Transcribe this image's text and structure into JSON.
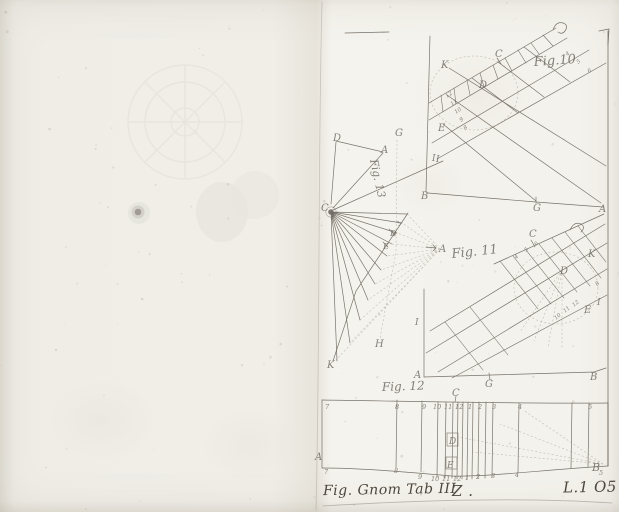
{
  "colors": {
    "paper": "#f0eee7",
    "plate_paper": "#f4f2ec",
    "ink": "#514c44",
    "faint_ink": "#8c8779"
  },
  "caption": {
    "figure_line": "Fig. Gnom Tab III",
    "center_mark": "Z .",
    "signature": "L.1 O5"
  },
  "figures": {
    "fig10": {
      "labels": [
        {
          "n": "title",
          "t": "Fig.10",
          "x": 534,
          "y": 66,
          "s": 13,
          "r": -4
        },
        {
          "n": "K",
          "t": "K",
          "x": 441,
          "y": 68,
          "s": 10
        },
        {
          "n": "C",
          "t": "C",
          "x": 495,
          "y": 57,
          "s": 10
        },
        {
          "n": "D",
          "t": "D",
          "x": 479,
          "y": 88,
          "s": 10
        },
        {
          "n": "E",
          "t": "E",
          "x": 438,
          "y": 131,
          "s": 10
        },
        {
          "n": "I",
          "t": "I",
          "x": 432,
          "y": 161,
          "s": 9
        },
        {
          "n": "B",
          "t": "B",
          "x": 421,
          "y": 199,
          "s": 10
        },
        {
          "n": "G",
          "t": "G",
          "x": 533,
          "y": 211,
          "s": 10
        },
        {
          "n": "A",
          "t": "A",
          "x": 599,
          "y": 212,
          "s": 10
        },
        {
          "n": "t4",
          "t": "4",
          "x": 567,
          "y": 56,
          "s": 5.5,
          "r": -35
        },
        {
          "n": "t5",
          "t": "5",
          "x": 578,
          "y": 64,
          "s": 5.5,
          "r": -35
        },
        {
          "n": "t6",
          "t": "6",
          "x": 589,
          "y": 73,
          "s": 5.5,
          "r": -35
        },
        {
          "n": "t12",
          "t": "12",
          "x": 447,
          "y": 98,
          "s": 5.5,
          "r": -35
        },
        {
          "n": "t11",
          "t": "11",
          "x": 452,
          "y": 106,
          "s": 5.5,
          "r": -35
        },
        {
          "n": "t10",
          "t": "10",
          "x": 456,
          "y": 114,
          "s": 5.5,
          "r": -35
        },
        {
          "n": "t9",
          "t": "9",
          "x": 461,
          "y": 122,
          "s": 5.5,
          "r": -35
        },
        {
          "n": "t8",
          "t": "8",
          "x": 465,
          "y": 130,
          "s": 5.5,
          "r": -35
        }
      ]
    },
    "fig11": {
      "labels": [
        {
          "n": "title",
          "t": "Fig. 11",
          "x": 452,
          "y": 258,
          "s": 13,
          "r": -6
        },
        {
          "n": "C",
          "t": "C",
          "x": 529,
          "y": 237,
          "s": 10
        },
        {
          "n": "K",
          "t": "K",
          "x": 588,
          "y": 257,
          "s": 10
        },
        {
          "n": "D",
          "t": "D",
          "x": 560,
          "y": 274,
          "s": 10
        },
        {
          "n": "E",
          "t": "E",
          "x": 584,
          "y": 313,
          "s": 10
        },
        {
          "n": "I-right",
          "t": "I",
          "x": 597,
          "y": 305,
          "s": 9
        },
        {
          "n": "I-left",
          "t": "I",
          "x": 415,
          "y": 325,
          "s": 9
        },
        {
          "n": "A",
          "t": "A",
          "x": 414,
          "y": 378,
          "s": 10
        },
        {
          "n": "G",
          "t": "G",
          "x": 485,
          "y": 387,
          "s": 10
        },
        {
          "n": "B",
          "t": "B",
          "x": 590,
          "y": 380,
          "s": 10
        },
        {
          "n": "t4",
          "t": "4",
          "x": 516,
          "y": 259,
          "s": 5.5,
          "r": -40
        },
        {
          "n": "t5",
          "t": "5",
          "x": 526,
          "y": 252,
          "s": 5.5,
          "r": -40
        },
        {
          "n": "t6",
          "t": "6",
          "x": 536,
          "y": 246,
          "s": 5.5,
          "r": -40
        },
        {
          "n": "t10",
          "t": "10",
          "x": 556,
          "y": 320,
          "s": 5.5,
          "r": -40
        },
        {
          "n": "t11",
          "t": "11",
          "x": 565,
          "y": 313,
          "s": 5.5,
          "r": -40
        },
        {
          "n": "t12",
          "t": "12",
          "x": 574,
          "y": 307,
          "s": 5.5,
          "r": -40
        },
        {
          "n": "t8",
          "t": "8",
          "x": 597,
          "y": 286,
          "s": 5.5,
          "r": -40
        }
      ]
    },
    "fig12": {
      "labels": [
        {
          "n": "title",
          "t": "Fig. 12",
          "x": 382,
          "y": 391,
          "s": 12,
          "r": -2
        },
        {
          "n": "C",
          "t": "C",
          "x": 452,
          "y": 396,
          "s": 10
        },
        {
          "n": "D",
          "t": "D",
          "x": 449,
          "y": 444,
          "s": 9
        },
        {
          "n": "E",
          "t": "E",
          "x": 447,
          "y": 468,
          "s": 9
        },
        {
          "n": "A",
          "t": "A",
          "x": 315,
          "y": 460,
          "s": 10
        },
        {
          "n": "B",
          "t": "B",
          "x": 592,
          "y": 471,
          "s": 11
        },
        {
          "n": "top-7",
          "t": "7",
          "x": 325,
          "y": 409,
          "s": 6.5
        },
        {
          "n": "top-8",
          "t": "8",
          "x": 395,
          "y": 409,
          "s": 6.5
        },
        {
          "n": "top-9",
          "t": "9",
          "x": 422,
          "y": 409,
          "s": 6.5
        },
        {
          "n": "top-10",
          "t": "10",
          "x": 433,
          "y": 409,
          "s": 6.5
        },
        {
          "n": "top-11",
          "t": "11",
          "x": 444,
          "y": 409,
          "s": 6.5
        },
        {
          "n": "top-12",
          "t": "12",
          "x": 455,
          "y": 409,
          "s": 6.5
        },
        {
          "n": "top-1",
          "t": "1",
          "x": 468,
          "y": 409,
          "s": 6.5
        },
        {
          "n": "top-2",
          "t": "2",
          "x": 478,
          "y": 409,
          "s": 6.5
        },
        {
          "n": "top-3",
          "t": "3",
          "x": 492,
          "y": 409,
          "s": 6.5
        },
        {
          "n": "top-4",
          "t": "4",
          "x": 518,
          "y": 409,
          "s": 6.5
        },
        {
          "n": "top-5",
          "t": "5",
          "x": 588,
          "y": 409,
          "s": 6.5
        },
        {
          "n": "bot-7",
          "t": "7",
          "x": 324,
          "y": 474,
          "s": 6.5
        },
        {
          "n": "bot-8",
          "t": "8",
          "x": 394,
          "y": 473,
          "s": 6.5
        },
        {
          "n": "bot-9",
          "t": "9",
          "x": 418,
          "y": 479,
          "s": 6.5
        },
        {
          "n": "bot-10",
          "t": "10",
          "x": 431,
          "y": 481,
          "s": 6.5
        },
        {
          "n": "bot-11",
          "t": "11",
          "x": 442,
          "y": 481,
          "s": 6.5
        },
        {
          "n": "bot-12",
          "t": "12",
          "x": 453,
          "y": 481,
          "s": 6.5
        },
        {
          "n": "bot-1",
          "t": "1",
          "x": 465,
          "y": 480,
          "s": 6.5
        },
        {
          "n": "bot-2",
          "t": "2",
          "x": 476,
          "y": 479,
          "s": 6.5
        },
        {
          "n": "bot-3",
          "t": "3",
          "x": 491,
          "y": 478,
          "s": 6.5
        },
        {
          "n": "bot-4",
          "t": "4",
          "x": 515,
          "y": 477,
          "s": 6.5
        },
        {
          "n": "bot-5",
          "t": "5",
          "x": 599,
          "y": 475,
          "s": 6.5
        }
      ]
    },
    "fig13": {
      "labels": [
        {
          "n": "title",
          "t": "Fig. 13",
          "x": 370,
          "y": 160,
          "s": 11,
          "r": 78
        },
        {
          "n": "D-top",
          "t": "D",
          "x": 333,
          "y": 141,
          "s": 10
        },
        {
          "n": "A-top",
          "t": "A",
          "x": 381,
          "y": 153,
          "s": 10
        },
        {
          "n": "G",
          "t": "G",
          "x": 395,
          "y": 136,
          "s": 10
        },
        {
          "n": "I",
          "t": "I",
          "x": 436,
          "y": 162,
          "s": 9
        },
        {
          "n": "C-hub",
          "t": "C",
          "x": 321,
          "y": 211,
          "s": 10
        },
        {
          "n": "D-mid",
          "t": "D",
          "x": 390,
          "y": 236,
          "s": 8
        },
        {
          "n": "E-mid",
          "t": "E",
          "x": 383,
          "y": 249,
          "s": 8
        },
        {
          "n": "A-right",
          "t": "A",
          "x": 439,
          "y": 252,
          "s": 10
        },
        {
          "n": "H",
          "t": "H",
          "x": 375,
          "y": 347,
          "s": 10
        },
        {
          "n": "K",
          "t": "K",
          "x": 327,
          "y": 368,
          "s": 10
        },
        {
          "n": "tick-3",
          "t": "3",
          "x": 399,
          "y": 226,
          "s": 6,
          "r": -50
        },
        {
          "n": "tick-4",
          "t": "4",
          "x": 394,
          "y": 237,
          "s": 6,
          "r": -50
        }
      ]
    }
  }
}
